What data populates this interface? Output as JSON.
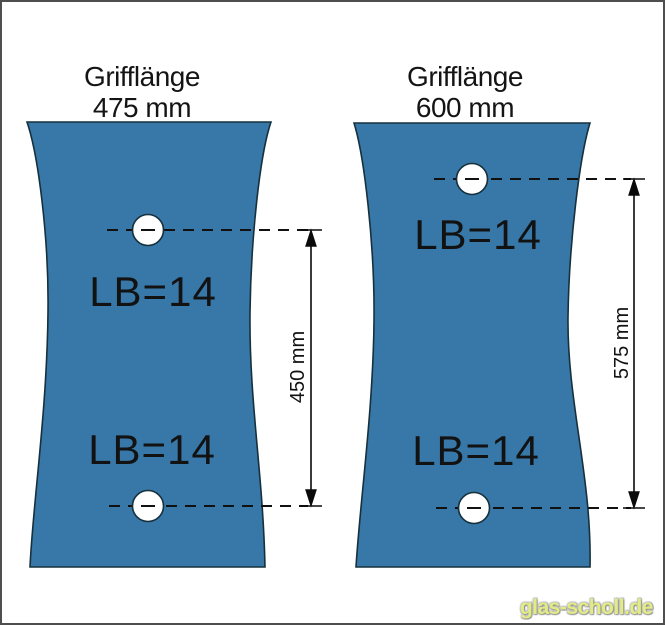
{
  "diagram": {
    "type": "technical-drawing",
    "subject": "glass door panels with handle drill holes",
    "panels": [
      {
        "title": "Grifflänge",
        "subtitle": "475 mm",
        "top_hole_label": "LB=14",
        "bottom_hole_label": "LB=14",
        "hole_spacing": "450 mm"
      },
      {
        "title": "Grifflänge",
        "subtitle": "600 mm",
        "top_hole_label": "LB=14",
        "bottom_hole_label": "LB=14",
        "hole_spacing": "575 mm"
      }
    ],
    "watermark": "glas-scholl.de",
    "colors": {
      "glass": "#3778a8",
      "panel_outline": "#16303c",
      "dimension_line": "#0a0a0a",
      "watermark_text": "#e3ec83",
      "background": "#ffffff",
      "frame_border": "#4e4e4e"
    }
  }
}
